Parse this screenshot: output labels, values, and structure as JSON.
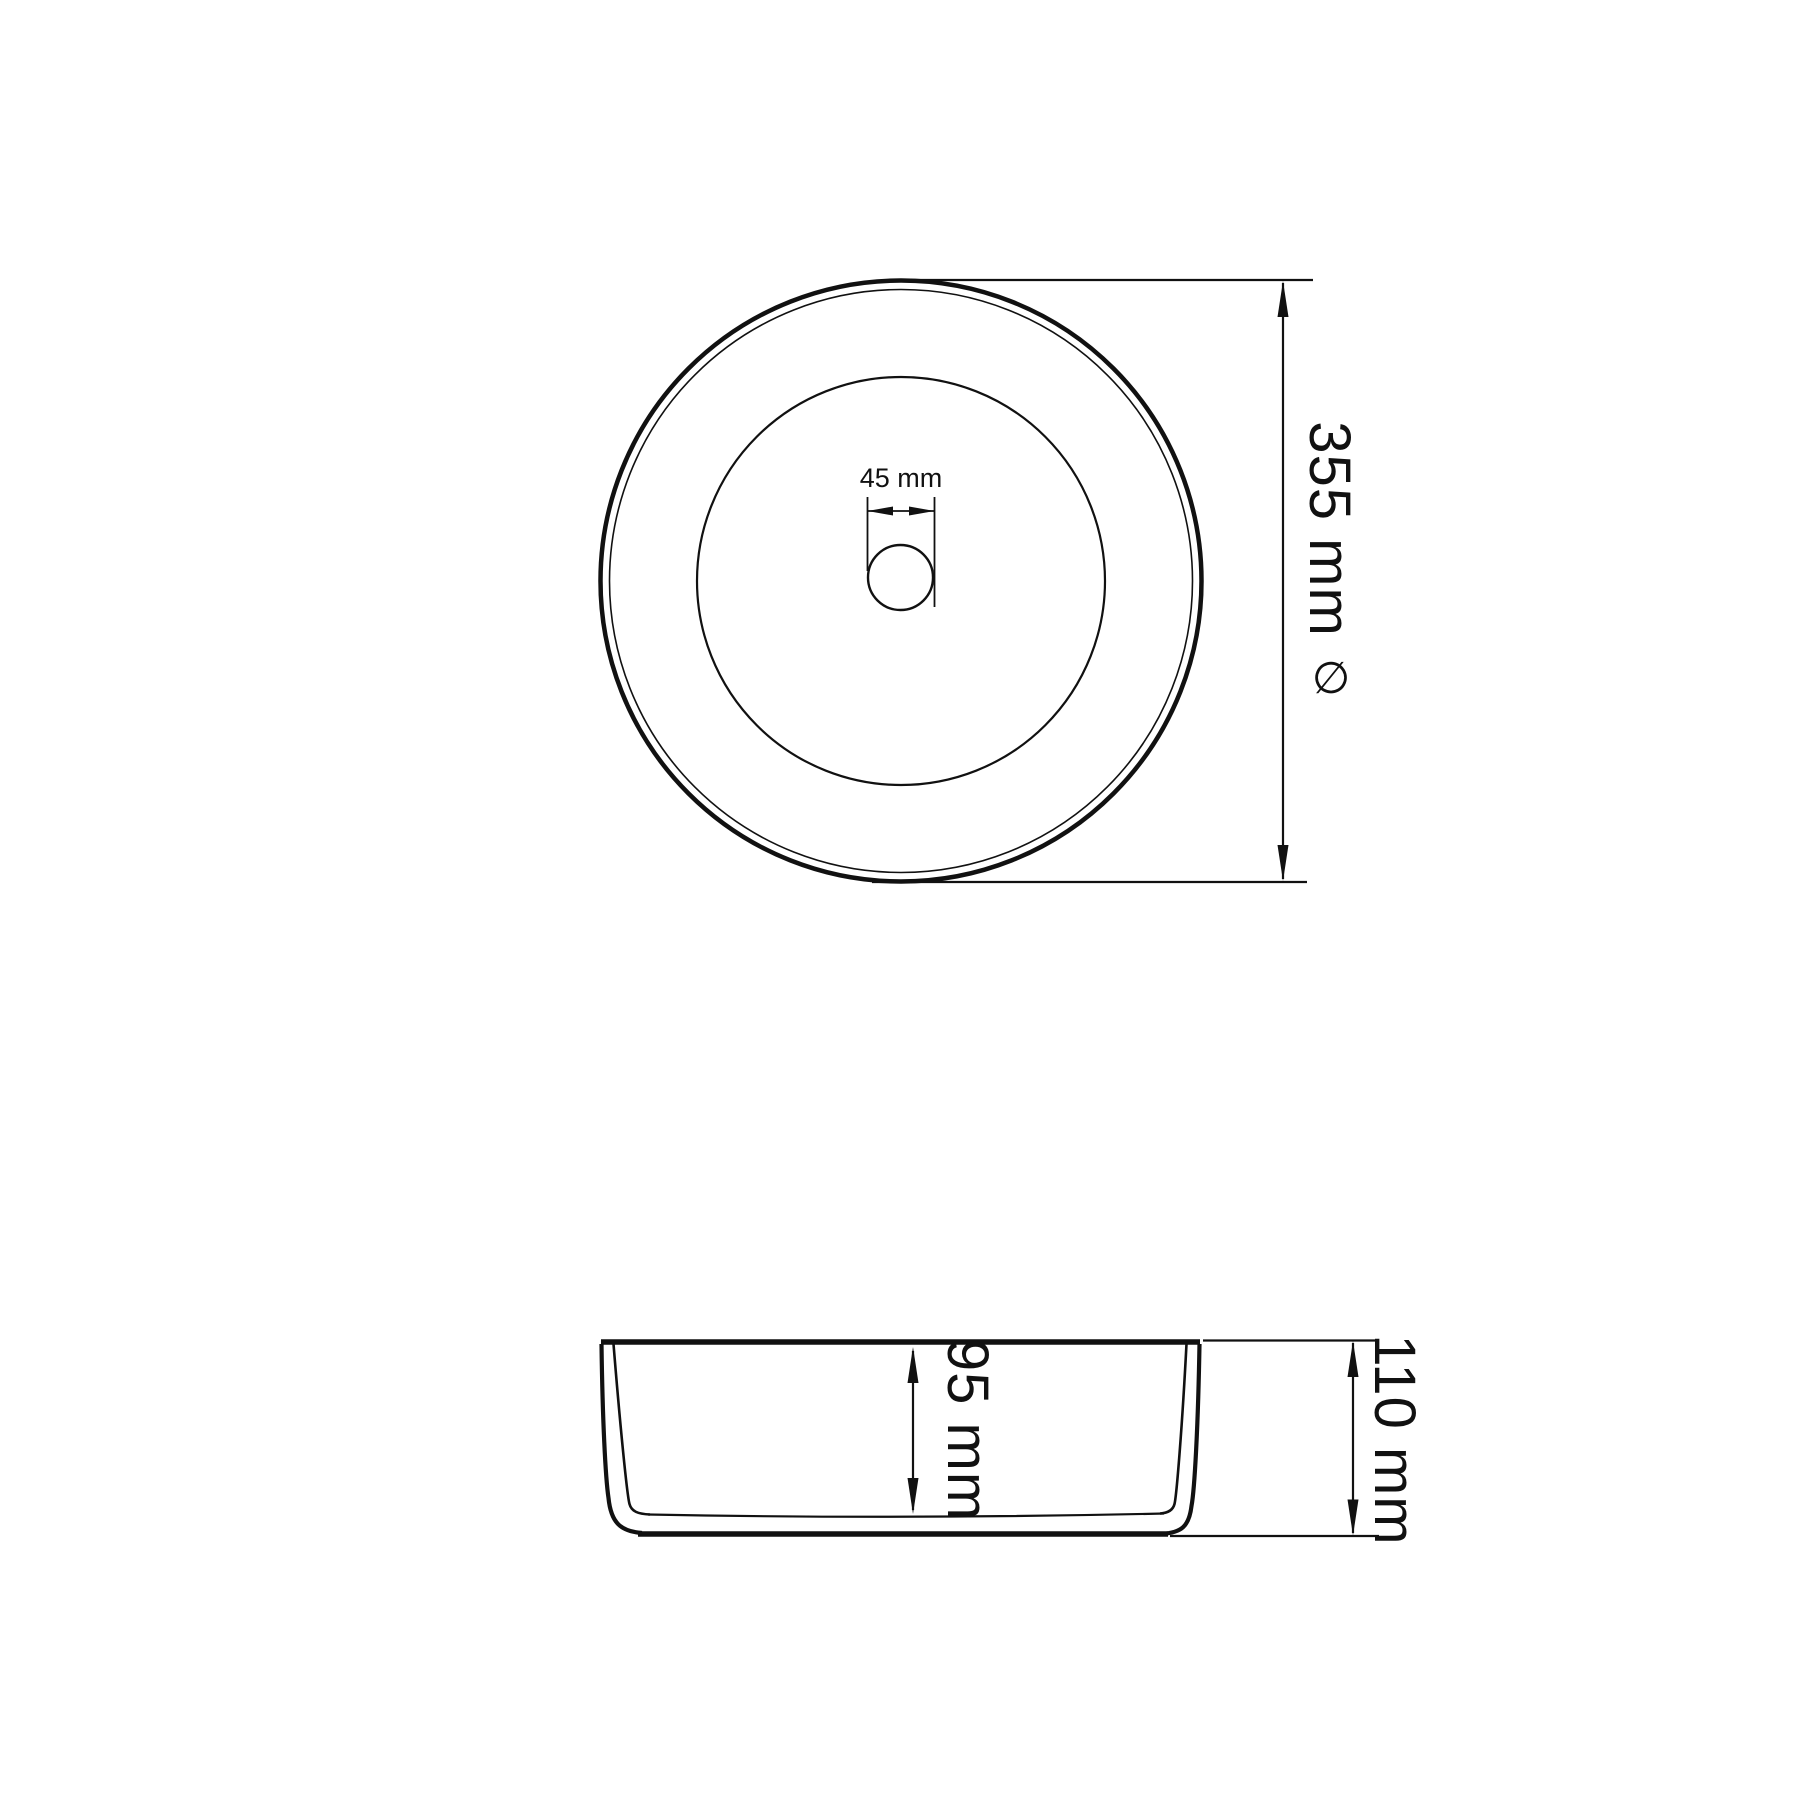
{
  "page": {
    "background": "#ffffff",
    "line_color": "#111111"
  },
  "drawing": {
    "type": "technical-drawing",
    "subject": "round countertop wash basin, top view and side view",
    "dimensions": {
      "diameter": {
        "label": "355 mm",
        "symbol": "∅"
      },
      "drain": {
        "label": "45 mm"
      },
      "inner_depth": {
        "label": "95 mm"
      },
      "overall_height": {
        "label": "110 mm"
      }
    }
  }
}
